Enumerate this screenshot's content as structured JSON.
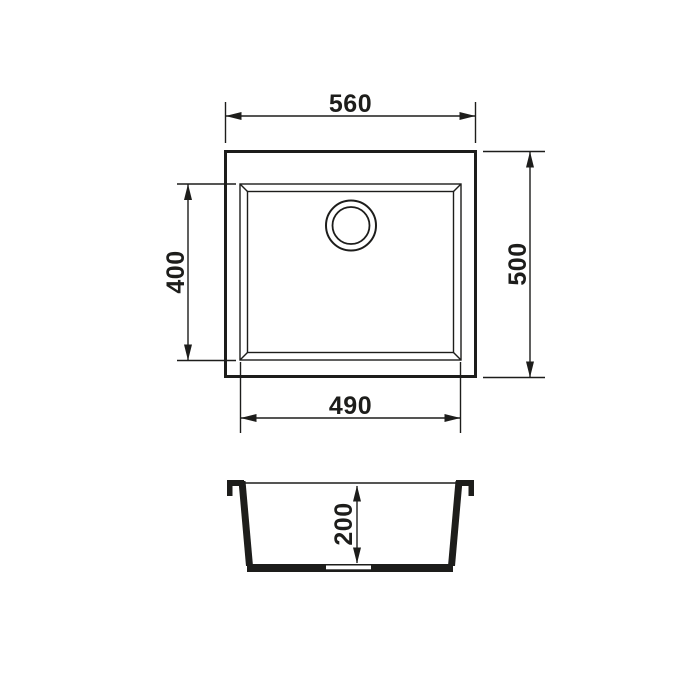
{
  "drawing": {
    "kind": "sink-technical-drawing",
    "dimensions": {
      "overall_width": "560",
      "overall_depth": "500",
      "bowl_depth": "400",
      "bowl_width": "490",
      "bowl_height": "200"
    }
  },
  "colors": {
    "line": "#1d1d1b",
    "background": "#ffffff"
  }
}
